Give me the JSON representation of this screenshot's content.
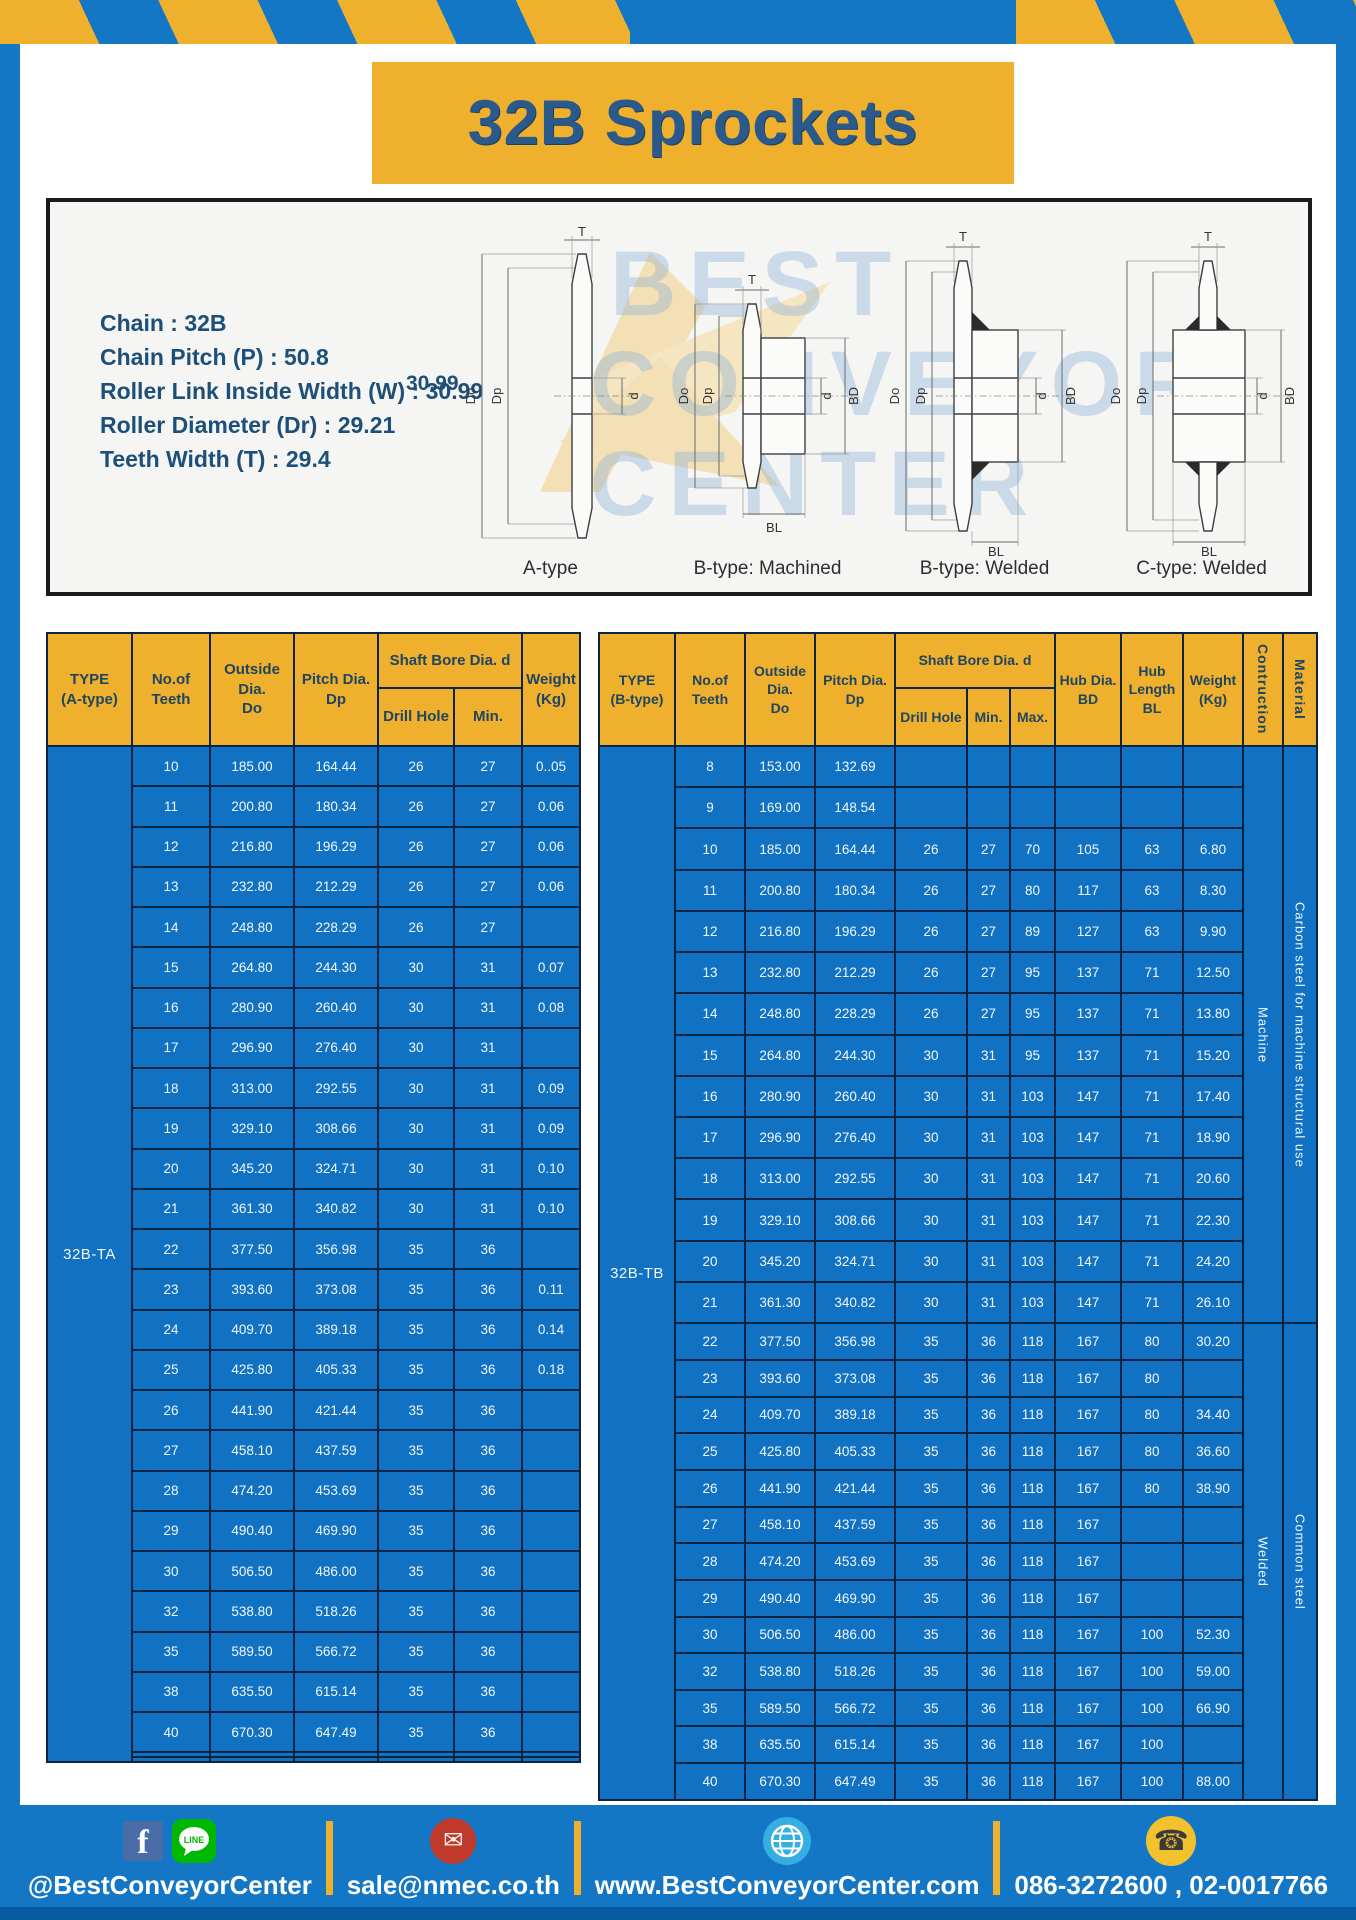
{
  "page_title": "32B Sprockets",
  "specs": [
    "Chain  : 32B",
    "Chain Pitch (P) :  50.8",
    "Roller Link Inside Width (W) :  30.99",
    "Roller Diameter (Dr) : 29.21",
    "Teeth Width (T) :  29.4"
  ],
  "diagram": {
    "w_value": "30.99",
    "labels": {
      "T": "T",
      "Do": "Do",
      "Dp": "Dp",
      "d": "d",
      "BD": "BD",
      "BL": "BL"
    },
    "captions": [
      "A-type",
      "B-type: Machined",
      "B-type: Welded",
      "C-type: Welded"
    ],
    "watermark": [
      "BEST",
      "CONVEYOR",
      "CENTER"
    ]
  },
  "table_a": {
    "headers": {
      "type": "TYPE\n(A-type)",
      "teeth": "No.of\nTeeth",
      "outside": "Outside\nDia.\nDo",
      "pitch": "Pitch Dia.\nDp",
      "shaft": "Shaft Bore Dia. d",
      "drill": "Drill Hole",
      "min": "Min.",
      "weight": "Weight\n(Kg)"
    },
    "type_label": "32B-TA",
    "rows": [
      [
        "10",
        "185.00",
        "164.44",
        "26",
        "27",
        "0..05"
      ],
      [
        "11",
        "200.80",
        "180.34",
        "26",
        "27",
        "0.06"
      ],
      [
        "12",
        "216.80",
        "196.29",
        "26",
        "27",
        "0.06"
      ],
      [
        "13",
        "232.80",
        "212.29",
        "26",
        "27",
        "0.06"
      ],
      [
        "14",
        "248.80",
        "228.29",
        "26",
        "27",
        ""
      ],
      [
        "15",
        "264.80",
        "244.30",
        "30",
        "31",
        "0.07"
      ],
      [
        "16",
        "280.90",
        "260.40",
        "30",
        "31",
        "0.08"
      ],
      [
        "17",
        "296.90",
        "276.40",
        "30",
        "31",
        ""
      ],
      [
        "18",
        "313.00",
        "292.55",
        "30",
        "31",
        "0.09"
      ],
      [
        "19",
        "329.10",
        "308.66",
        "30",
        "31",
        "0.09"
      ],
      [
        "20",
        "345.20",
        "324.71",
        "30",
        "31",
        "0.10"
      ],
      [
        "21",
        "361.30",
        "340.82",
        "30",
        "31",
        "0.10"
      ],
      [
        "22",
        "377.50",
        "356.98",
        "35",
        "36",
        ""
      ],
      [
        "23",
        "393.60",
        "373.08",
        "35",
        "36",
        "0.11"
      ],
      [
        "24",
        "409.70",
        "389.18",
        "35",
        "36",
        "0.14"
      ],
      [
        "25",
        "425.80",
        "405.33",
        "35",
        "36",
        "0.18"
      ],
      [
        "26",
        "441.90",
        "421.44",
        "35",
        "36",
        ""
      ],
      [
        "27",
        "458.10",
        "437.59",
        "35",
        "36",
        ""
      ],
      [
        "28",
        "474.20",
        "453.69",
        "35",
        "36",
        ""
      ],
      [
        "29",
        "490.40",
        "469.90",
        "35",
        "36",
        ""
      ],
      [
        "30",
        "506.50",
        "486.00",
        "35",
        "36",
        ""
      ],
      [
        "32",
        "538.80",
        "518.26",
        "35",
        "36",
        ""
      ],
      [
        "35",
        "589.50",
        "566.72",
        "35",
        "36",
        ""
      ],
      [
        "38",
        "635.50",
        "615.14",
        "35",
        "36",
        ""
      ],
      [
        "40",
        "670.30",
        "647.49",
        "35",
        "36",
        ""
      ],
      [
        "",
        "",
        "",
        "",
        "",
        ""
      ],
      [
        "",
        "",
        "",
        "",
        "",
        ""
      ]
    ]
  },
  "table_b": {
    "headers": {
      "type": "TYPE\n(B-type)",
      "teeth": "No.of\nTeeth",
      "outside": "Outside\nDia.\nDo",
      "pitch": "Pitch Dia.\nDp",
      "shaft": "Shaft Bore Dia. d",
      "drill": "Drill Hole",
      "min": "Min.",
      "max": "Max.",
      "hub_dia": "Hub Dia.\nBD",
      "hub_len": "Hub\nLength\nBL",
      "weight": "Weight\n(Kg)",
      "construction": "Contruction",
      "material": "Material"
    },
    "type_label": "32B-TB",
    "sections": [
      {
        "construction": "Machine",
        "material": "Carbon steel for machine structural use",
        "span": 14
      },
      {
        "construction": "Welded",
        "material": "Common steel",
        "span": 13
      }
    ],
    "rows": [
      [
        "8",
        "153.00",
        "132.69",
        "",
        "",
        "",
        "",
        "",
        ""
      ],
      [
        "9",
        "169.00",
        "148.54",
        "",
        "",
        "",
        "",
        "",
        ""
      ],
      [
        "10",
        "185.00",
        "164.44",
        "26",
        "27",
        "70",
        "105",
        "63",
        "6.80"
      ],
      [
        "11",
        "200.80",
        "180.34",
        "26",
        "27",
        "80",
        "117",
        "63",
        "8.30"
      ],
      [
        "12",
        "216.80",
        "196.29",
        "26",
        "27",
        "89",
        "127",
        "63",
        "9.90"
      ],
      [
        "13",
        "232.80",
        "212.29",
        "26",
        "27",
        "95",
        "137",
        "71",
        "12.50"
      ],
      [
        "14",
        "248.80",
        "228.29",
        "26",
        "27",
        "95",
        "137",
        "71",
        "13.80"
      ],
      [
        "15",
        "264.80",
        "244.30",
        "30",
        "31",
        "95",
        "137",
        "71",
        "15.20"
      ],
      [
        "16",
        "280.90",
        "260.40",
        "30",
        "31",
        "103",
        "147",
        "71",
        "17.40"
      ],
      [
        "17",
        "296.90",
        "276.40",
        "30",
        "31",
        "103",
        "147",
        "71",
        "18.90"
      ],
      [
        "18",
        "313.00",
        "292.55",
        "30",
        "31",
        "103",
        "147",
        "71",
        "20.60"
      ],
      [
        "19",
        "329.10",
        "308.66",
        "30",
        "31",
        "103",
        "147",
        "71",
        "22.30"
      ],
      [
        "20",
        "345.20",
        "324.71",
        "30",
        "31",
        "103",
        "147",
        "71",
        "24.20"
      ],
      [
        "21",
        "361.30",
        "340.82",
        "30",
        "31",
        "103",
        "147",
        "71",
        "26.10"
      ],
      [
        "22",
        "377.50",
        "356.98",
        "35",
        "36",
        "118",
        "167",
        "80",
        "30.20"
      ],
      [
        "23",
        "393.60",
        "373.08",
        "35",
        "36",
        "118",
        "167",
        "80",
        ""
      ],
      [
        "24",
        "409.70",
        "389.18",
        "35",
        "36",
        "118",
        "167",
        "80",
        "34.40"
      ],
      [
        "25",
        "425.80",
        "405.33",
        "35",
        "36",
        "118",
        "167",
        "80",
        "36.60"
      ],
      [
        "26",
        "441.90",
        "421.44",
        "35",
        "36",
        "118",
        "167",
        "80",
        "38.90"
      ],
      [
        "27",
        "458.10",
        "437.59",
        "35",
        "36",
        "118",
        "167",
        "",
        ""
      ],
      [
        "28",
        "474.20",
        "453.69",
        "35",
        "36",
        "118",
        "167",
        "",
        ""
      ],
      [
        "29",
        "490.40",
        "469.90",
        "35",
        "36",
        "118",
        "167",
        "",
        ""
      ],
      [
        "30",
        "506.50",
        "486.00",
        "35",
        "36",
        "118",
        "167",
        "100",
        "52.30"
      ],
      [
        "32",
        "538.80",
        "518.26",
        "35",
        "36",
        "118",
        "167",
        "100",
        "59.00"
      ],
      [
        "35",
        "589.50",
        "566.72",
        "35",
        "36",
        "118",
        "167",
        "100",
        "66.90"
      ],
      [
        "38",
        "635.50",
        "615.14",
        "35",
        "36",
        "118",
        "167",
        "100",
        ""
      ],
      [
        "40",
        "670.30",
        "647.49",
        "35",
        "36",
        "118",
        "167",
        "100",
        "88.00"
      ]
    ]
  },
  "footer": {
    "social_label": "@BestConveyorCenter",
    "email_label": "sale@nmec.co.th",
    "web_label": "www.BestConveyorCenter.com",
    "phone_label": "086-3272600 , 02-0017766",
    "line_text": "LINE"
  },
  "colors": {
    "frame_blue": "#1377c5",
    "table_blue": "#1172c4",
    "accent_yellow": "#eeb02d",
    "navy_text": "#2a5a8c",
    "footer_dark_strip": "#0a5aa3"
  }
}
